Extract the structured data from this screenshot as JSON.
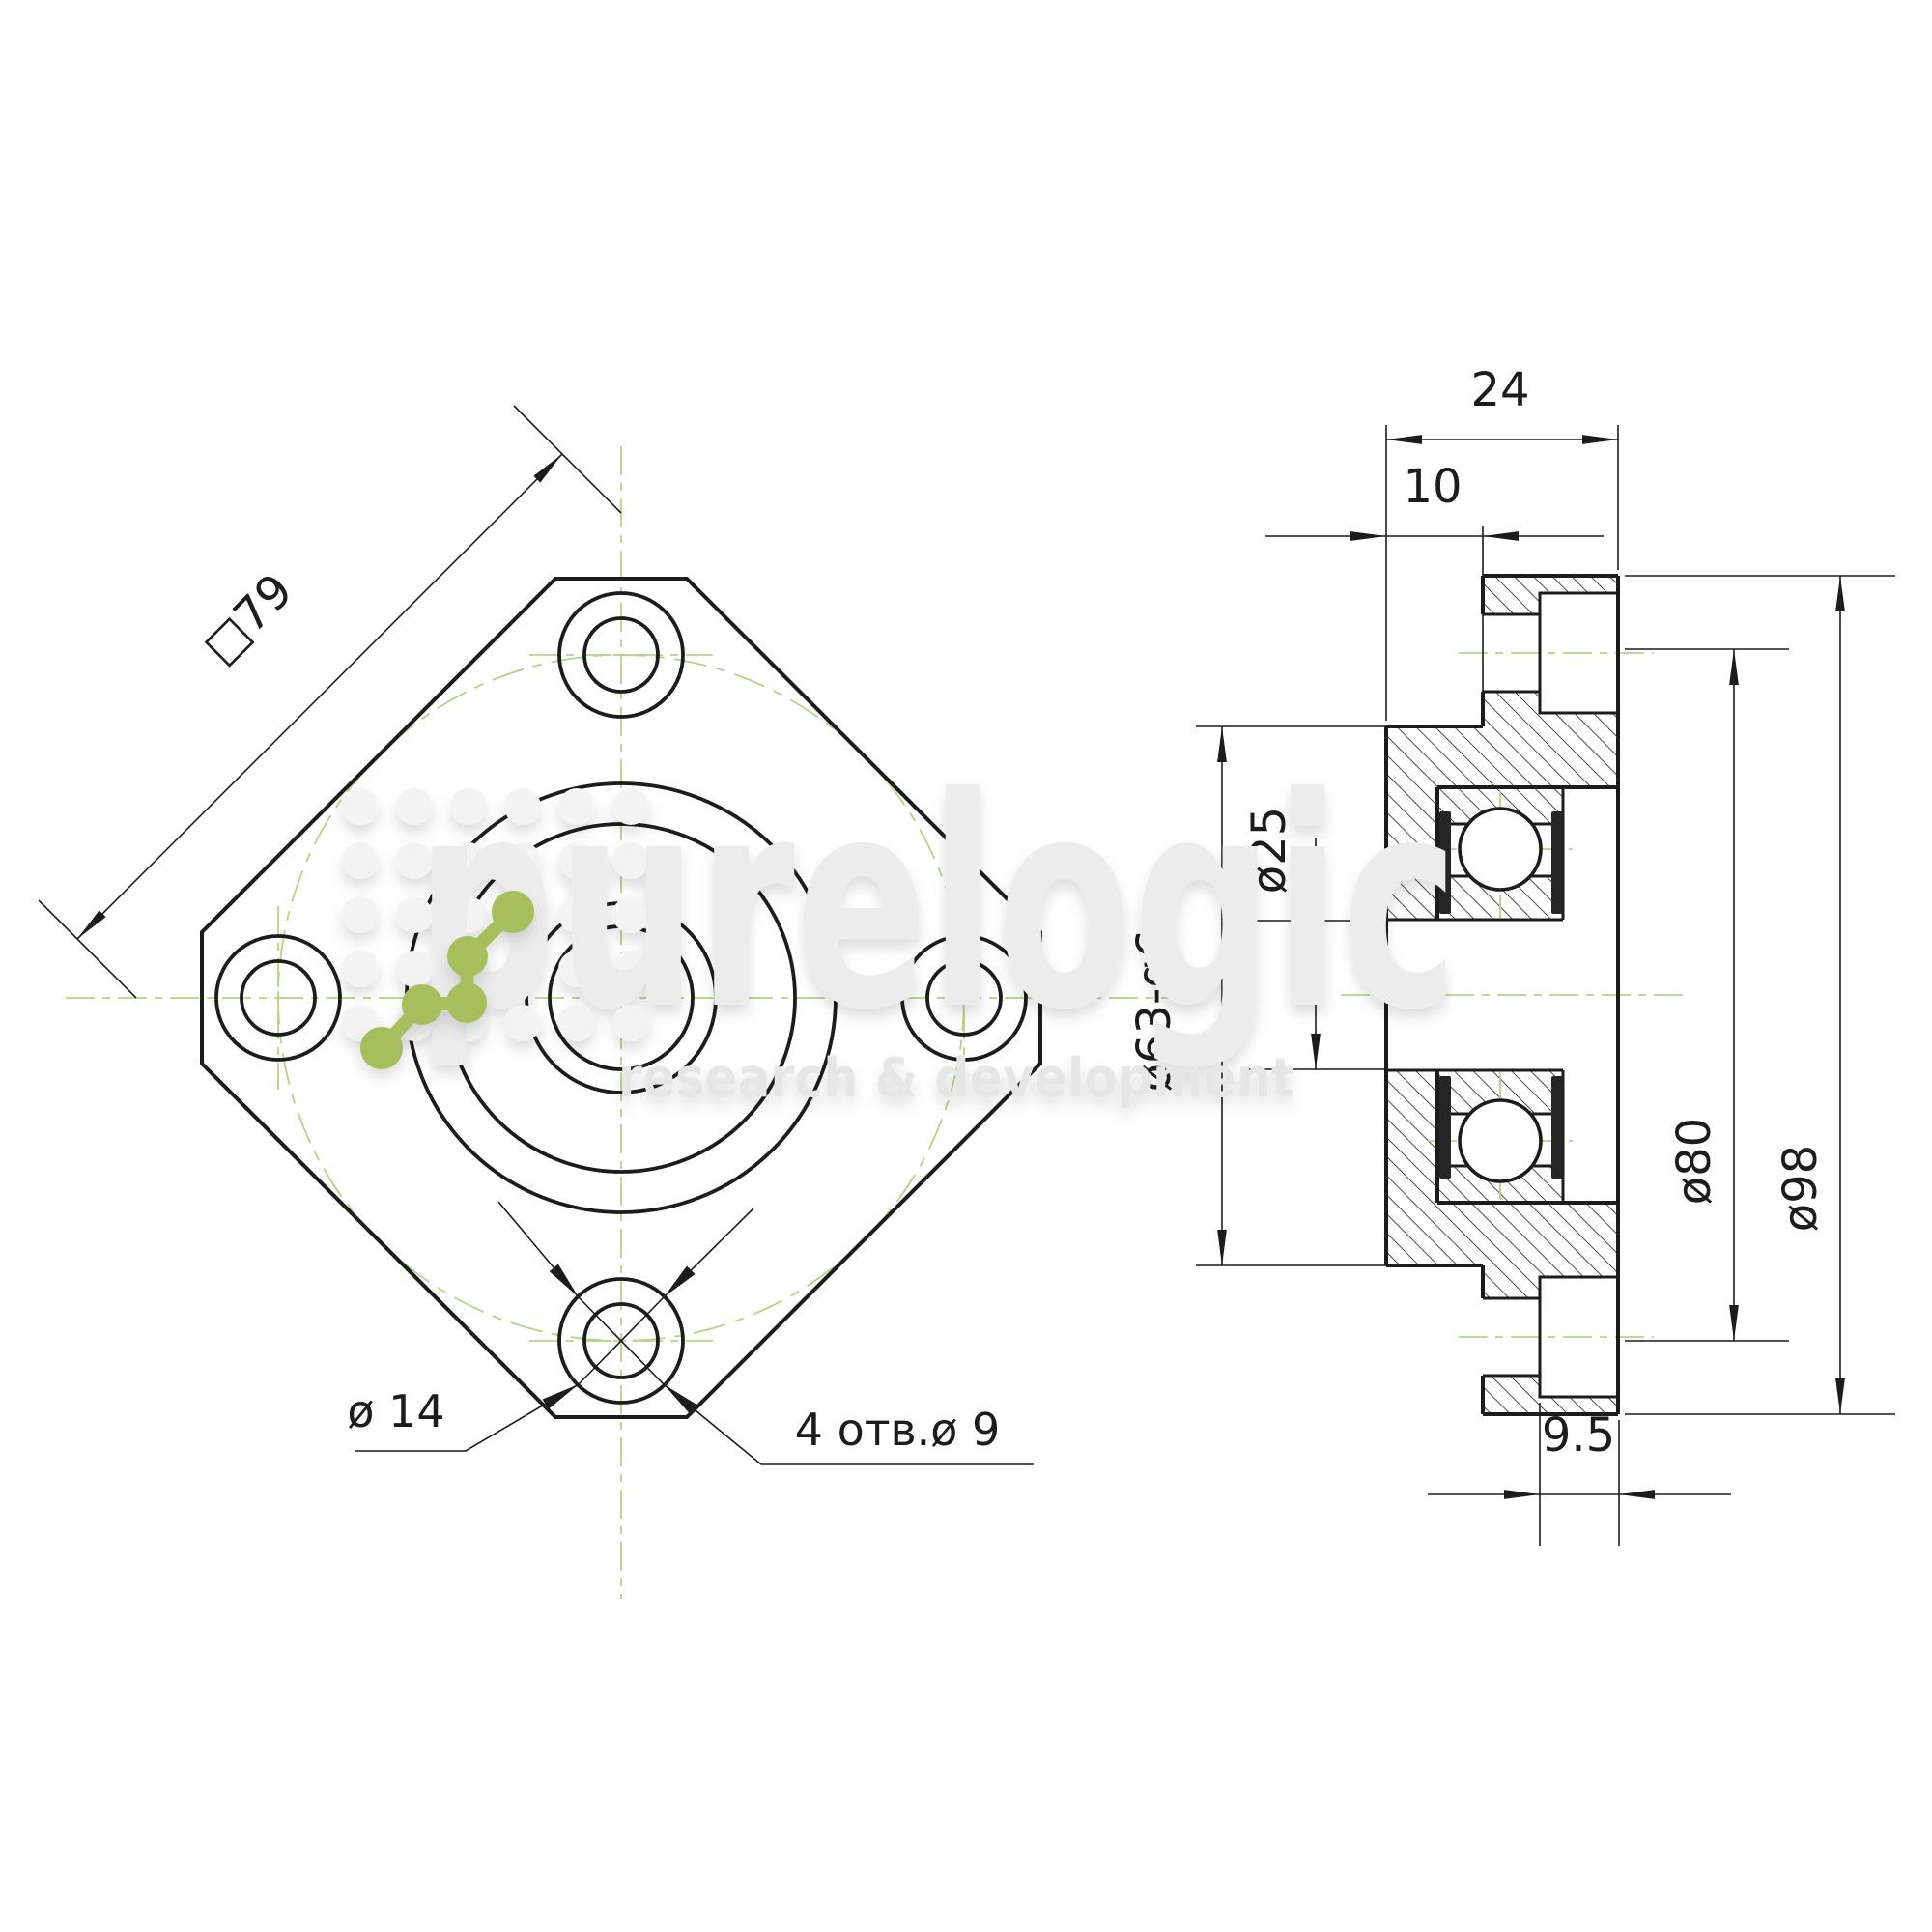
{
  "drawing": {
    "kind": "technical-drawing",
    "part": "flanged ballscrew support bearing unit, front view and side section view",
    "dims": {
      "square": "□79",
      "counterbore_dia": "ø 14",
      "holes_note": "4 отв.ø 9",
      "total_width": "24",
      "pilot_length": "10",
      "bore_dia": "ø25",
      "pilot_dia": "ø63-g6",
      "bolt_circle_dia": "ø80",
      "outer_dia": "ø98",
      "counterbore_depth": "9.5"
    },
    "watermark": {
      "brand": "purelogic",
      "tagline": "research & development"
    },
    "colors": {
      "line": "#1c1c1c",
      "centerline_green": "#b4d482",
      "logo_green": "#a4bf5c",
      "watermark_gray": "#ececec",
      "background": "#ffffff"
    }
  }
}
